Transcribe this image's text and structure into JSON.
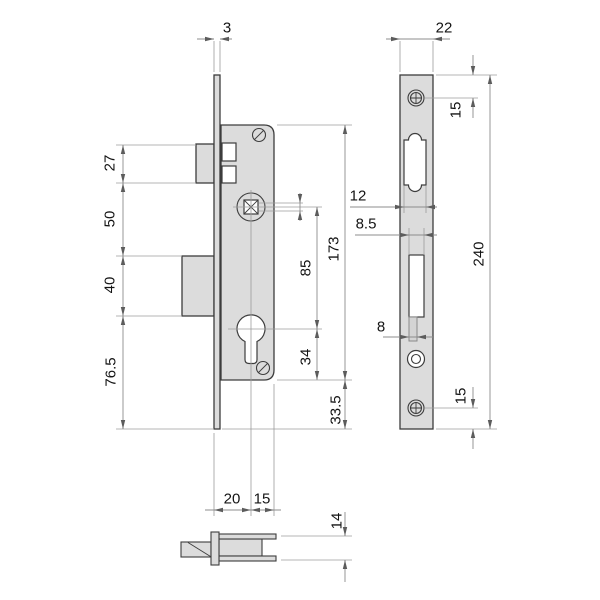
{
  "drawing_type": "mortise-lock technical drawing, three views",
  "colors": {
    "background": "#ffffff",
    "part_fill": "#dcdcdc",
    "part_outline": "#3d3d3d",
    "dimension_line": "#8c8c8c",
    "dimension_text": "#141414"
  },
  "dims": {
    "plate_thickness": "3",
    "plate_width": "22",
    "latch_height": "27",
    "gap_latch_deadbolt": "50",
    "deadbolt_height": "40",
    "below_deadbolt": "76.5",
    "latch_cutout_width": "12",
    "deadbolt_cutout_width": "8.5",
    "slot_width": "8",
    "spindle_to_cylinder": "85",
    "cylinder_to_case_end": "34",
    "case_height": "173",
    "case_to_plate_end": "33.5",
    "plate_length": "240",
    "screw_top_offset": "15",
    "screw_bottom_offset": "15",
    "backset": "20",
    "center_to_case_edge": "15",
    "case_depth": "14"
  }
}
